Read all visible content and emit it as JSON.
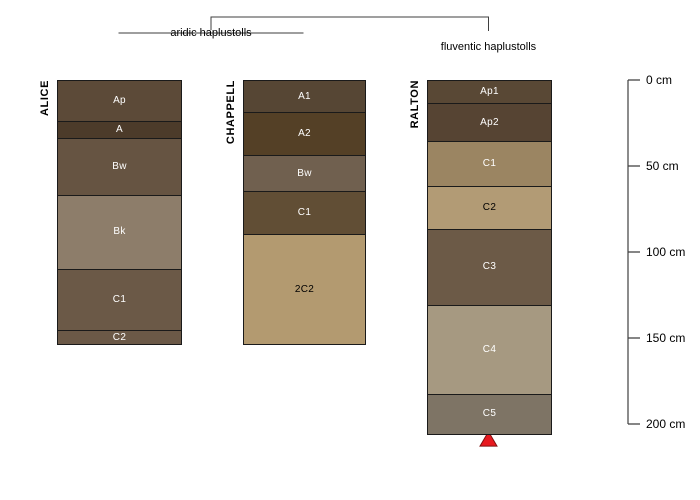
{
  "figure": {
    "background": "#ffffff",
    "kind": "soil profile comparison plot (R graphics style)"
  },
  "chart_data": {
    "type": "bar",
    "subtype": "soil-profile-sketch",
    "title": "",
    "depth_axis": {
      "unit": "cm",
      "range": [
        0,
        200
      ],
      "ticks": [
        {
          "depth": 0,
          "label": "0 cm"
        },
        {
          "depth": 50,
          "label": "50 cm"
        },
        {
          "depth": 100,
          "label": "100 cm"
        },
        {
          "depth": 150,
          "label": "150 cm"
        },
        {
          "depth": 200,
          "label": "200 cm"
        }
      ]
    },
    "groups": [
      {
        "label": "aridic haplustolls",
        "profiles": [
          "ALICE",
          "CHAPPELL"
        ],
        "underline_color": "#7f7f7f"
      },
      {
        "label": "fluventic haplustolls",
        "profiles": [
          "RALTON"
        ]
      }
    ],
    "bracket_color": "#3f3f3f",
    "axis_color": "#3f3f3f",
    "horizon_border_color": "#1a1a1a",
    "profiles": [
      {
        "name": "ALICE",
        "horizons": [
          {
            "name": "Ap",
            "top": 0,
            "bottom": 23,
            "color": "#5c4a38",
            "label_color": "#ffffff"
          },
          {
            "name": "A",
            "top": 23,
            "bottom": 33,
            "color": "#4c3b2a",
            "label_color": "#ffffff"
          },
          {
            "name": "Bw",
            "top": 33,
            "bottom": 66,
            "color": "#665442",
            "label_color": "#ffffff"
          },
          {
            "name": "Bk",
            "top": 66,
            "bottom": 109,
            "color": "#8d7d6a",
            "label_color": "#ffffff"
          },
          {
            "name": "C1",
            "top": 109,
            "bottom": 145,
            "color": "#6b5947",
            "label_color": "#ffffff"
          },
          {
            "name": "C2",
            "top": 145,
            "bottom": 153,
            "color": "#6b5947",
            "label_color": "#ffffff"
          }
        ]
      },
      {
        "name": "CHAPPELL",
        "horizons": [
          {
            "name": "A1",
            "top": 0,
            "bottom": 18,
            "color": "#564634",
            "label_color": "#ffffff"
          },
          {
            "name": "A2",
            "top": 18,
            "bottom": 43,
            "color": "#544026",
            "label_color": "#ffffff"
          },
          {
            "name": "Bw",
            "top": 43,
            "bottom": 64,
            "color": "#70604f",
            "label_color": "#ffffff"
          },
          {
            "name": "C1",
            "top": 64,
            "bottom": 89,
            "color": "#614e35",
            "label_color": "#ffffff"
          },
          {
            "name": "2C2",
            "top": 89,
            "bottom": 153,
            "color": "#b39a70",
            "label_color": "#000000"
          }
        ]
      },
      {
        "name": "RALTON",
        "horizons": [
          {
            "name": "Ap1",
            "top": 0,
            "bottom": 13,
            "color": "#594835",
            "label_color": "#ffffff"
          },
          {
            "name": "Ap2",
            "top": 13,
            "bottom": 35,
            "color": "#564433",
            "label_color": "#ffffff"
          },
          {
            "name": "C1",
            "top": 35,
            "bottom": 61,
            "color": "#9b8562",
            "label_color": "#ffffff"
          },
          {
            "name": "C2",
            "top": 61,
            "bottom": 86,
            "color": "#b29b75",
            "label_color": "#000000"
          },
          {
            "name": "C3",
            "top": 86,
            "bottom": 130,
            "color": "#6c5a47",
            "label_color": "#ffffff"
          },
          {
            "name": "C4",
            "top": 130,
            "bottom": 182,
            "color": "#a69981",
            "label_color": "#ffffff"
          },
          {
            "name": "C5",
            "top": 182,
            "bottom": 205,
            "color": "#7e7465",
            "label_color": "#ffffff"
          }
        ]
      }
    ],
    "marker": {
      "symbol": "filled-triangle-up",
      "fill": "#e8191f",
      "stroke": "#801010",
      "profile": "RALTON",
      "position": "below profile bottom"
    }
  }
}
